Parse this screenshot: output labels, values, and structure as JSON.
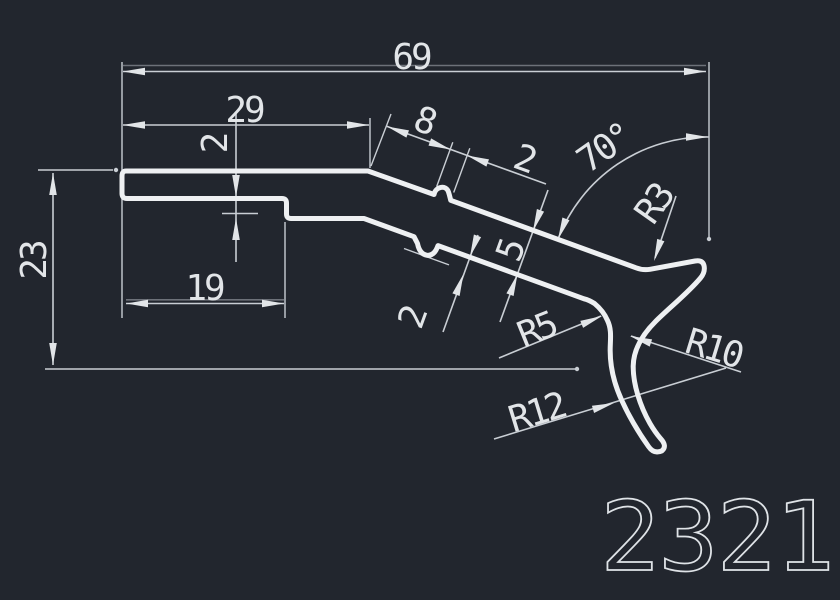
{
  "title": "CAD profile section drawing",
  "part_number": "2321",
  "dims": {
    "overall_width": "69",
    "upper_flat_width": "29",
    "notch_offset": "8",
    "notch_width": "2",
    "slant_angle": "70°",
    "tip_radius": "R3",
    "overall_height": "23",
    "step_depth": "2",
    "lower_flat_width": "19",
    "plate_thickness": "5",
    "lower_notch_depth": "2",
    "bend_radius": "R5",
    "hook_outer_radius": "R12",
    "hook_inner_radius": "R10"
  },
  "colors": {
    "background": "#22262e",
    "profile_line": "#eef0f2",
    "dimension_line": "#c9ced4",
    "text": "#e2e5e8"
  }
}
